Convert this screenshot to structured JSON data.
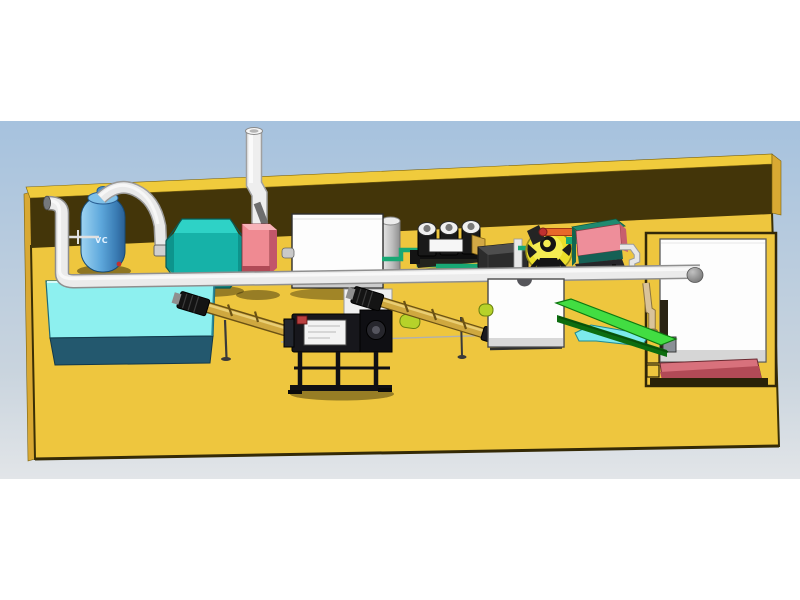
{
  "meta": {
    "title": "3D plant layout rendering",
    "view": "isometric CAD render of a pellet production line on a yellow platform"
  },
  "scene": {
    "labels": {
      "tank_label": "VC"
    },
    "palette": {
      "frame_white": "#ffffff",
      "sky_top": "#a6c2de",
      "sky_bottom": "#e2e5e8",
      "floor_yellow": "#eec63e",
      "wall_brown": "#433509",
      "wall_top_band": "#f0cb3c",
      "platform_edge": "#d9a933",
      "pipe_white": "#ebebeb",
      "tank_blue": "#5ea8dc",
      "water_tank_cyan": "#8df0ef",
      "water_tank_front": "#23586e",
      "blower_teal": "#16b2a8",
      "cabinet_pink": "#ee8e9a",
      "cabinet_white": "#fdfdfd",
      "auger_tan": "#cfa83f",
      "conveyor_green": "#42dd42",
      "fan_yellow": "#ecdf2a",
      "pipe_green": "#18a874",
      "pipe_orange": "#e8682a",
      "slab_pink": "#d8717c",
      "machinery_black": "#17171c",
      "chute_cyan": "#7ceaec"
    },
    "equipment": [
      {
        "id": "vertical-tank",
        "label": "VC",
        "color": "#5ea8dc"
      },
      {
        "id": "left-elbow-pipe",
        "color": "#ebebeb"
      },
      {
        "id": "overhead-arc-pipe",
        "color": "#e9e9e9"
      },
      {
        "id": "teal-blower-housing",
        "color": "#16b2a8"
      },
      {
        "id": "chimney-pipe",
        "color": "#eeeeee"
      },
      {
        "id": "small-pink-cabinet",
        "color": "#ee8e9a"
      },
      {
        "id": "white-cabinet",
        "color": "#fdfdfd"
      },
      {
        "id": "rear-gray-cylinder",
        "color": "#cccccc"
      },
      {
        "id": "triple-roller-unit",
        "color": "#191919"
      },
      {
        "id": "dark-crate",
        "color": "#2c2c2c"
      },
      {
        "id": "yellow-fan",
        "color": "#ecdf2a"
      },
      {
        "id": "pink-teal-cabinet",
        "color": "#ee8e9a"
      },
      {
        "id": "main-air-pipe",
        "color": "#ebebeb"
      },
      {
        "id": "cyan-water-tank",
        "color": "#8df0ef"
      },
      {
        "id": "screw-conveyor-1",
        "color": "#cfa83f"
      },
      {
        "id": "black-machine-unit",
        "color": "#17171c"
      },
      {
        "id": "screw-conveyor-2",
        "color": "#cfa83f"
      },
      {
        "id": "white-hopper-box",
        "color": "#fdfdfd"
      },
      {
        "id": "green-belt-conveyor",
        "color": "#42dd42"
      },
      {
        "id": "cyan-chute",
        "color": "#7ceaec"
      },
      {
        "id": "right-storage-cabin",
        "color": "#fdfdfd"
      },
      {
        "id": "pink-base-slab",
        "color": "#d8717c"
      },
      {
        "id": "yellow-platform",
        "color": "#eec63e"
      },
      {
        "id": "back-wall",
        "color": "#433509"
      }
    ]
  }
}
